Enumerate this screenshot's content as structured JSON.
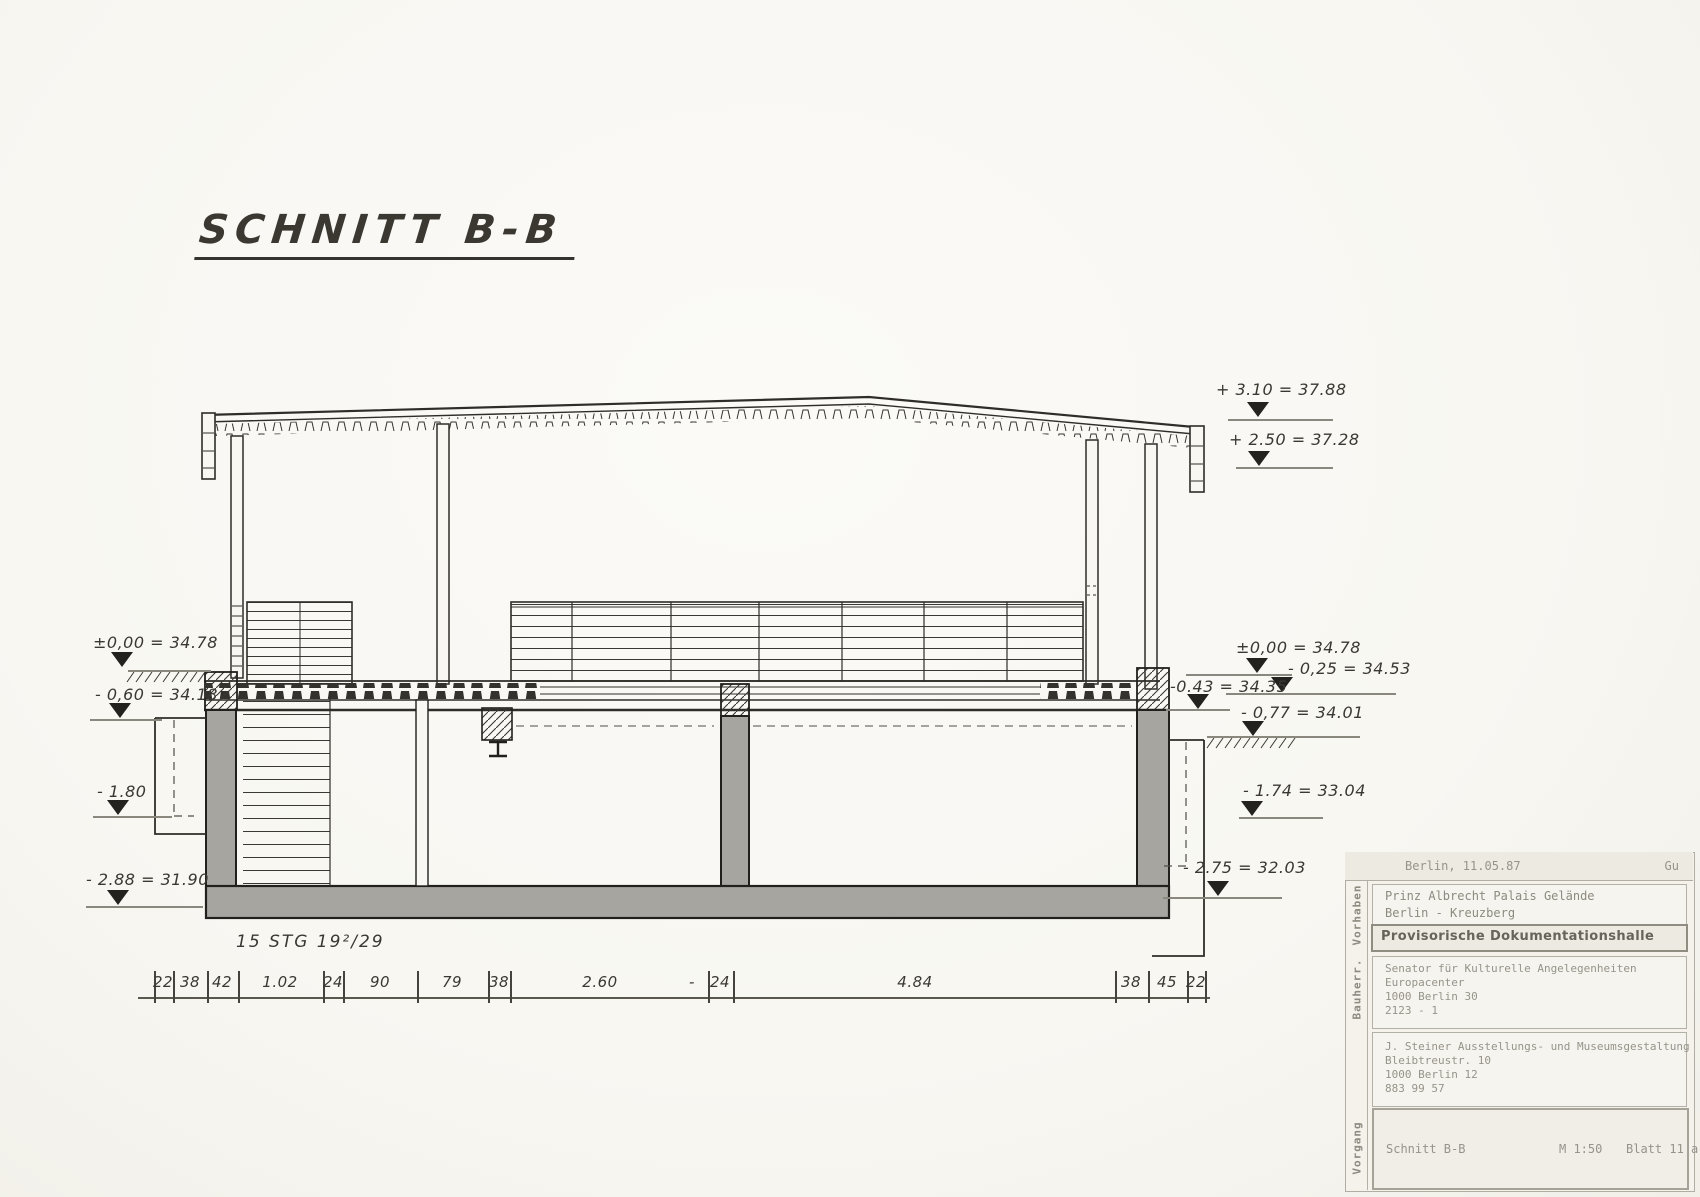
{
  "paper": {
    "background": "#f8f7f2",
    "ink": "#2e2d28",
    "concrete_fill": "#a7a5a0",
    "hand_ink": "#3a3831",
    "typewriter_ink": "#96938a"
  },
  "drawing_title": {
    "text": "SCHNITT B-B"
  },
  "stair_note": {
    "text": "15 STG 19²/29"
  },
  "elevation_markers": [
    {
      "side": "left",
      "label": "±0,00 = 34.78",
      "lx": 93,
      "ly": 633,
      "tx": 122,
      "ty": 652,
      "x1": 128,
      "x2": 211,
      "yl": 670
    },
    {
      "side": "left",
      "label": "- 0,60 = 34.18",
      "lx": 95,
      "ly": 685,
      "tx": 120,
      "ty": 703,
      "x1": 90,
      "x2": 162,
      "yl": 719
    },
    {
      "side": "left",
      "label": "- 1.80",
      "lx": 97,
      "ly": 782,
      "tx": 118,
      "ty": 800,
      "x1": 93,
      "x2": 172,
      "yl": 816
    },
    {
      "side": "left",
      "label": "- 2.88 = 31.90",
      "lx": 86,
      "ly": 870,
      "tx": 118,
      "ty": 890,
      "x1": 86,
      "x2": 203,
      "yl": 906
    },
    {
      "side": "right",
      "label": "+ 3.10 = 37.88",
      "lx": 1216,
      "ly": 380,
      "tx": 1258,
      "ty": 402,
      "x1": 1228,
      "x2": 1333,
      "yl": 419
    },
    {
      "side": "right",
      "label": "+ 2.50 = 37.28",
      "lx": 1229,
      "ly": 430,
      "tx": 1259,
      "ty": 451,
      "x1": 1236,
      "x2": 1333,
      "yl": 467
    },
    {
      "side": "right",
      "label": "±0,00  = 34.78",
      "lx": 1236,
      "ly": 638,
      "tx": 1257,
      "ty": 658,
      "x1": 1186,
      "x2": 1292,
      "yl": 674
    },
    {
      "side": "right",
      "label": "- 0,25 = 34.53",
      "lx": 1288,
      "ly": 659,
      "tx": 1282,
      "ty": 677,
      "x1": 1226,
      "x2": 1396,
      "yl": 693
    },
    {
      "side": "right",
      "label": "-0.43 = 34.35",
      "lx": 1170,
      "ly": 677,
      "tx": 1198,
      "ty": 694,
      "x1": 1166,
      "x2": 1230,
      "yl": 709
    },
    {
      "side": "right",
      "label": "- 0,77  = 34.01",
      "lx": 1241,
      "ly": 703,
      "tx": 1253,
      "ty": 721,
      "x1": 1207,
      "x2": 1360,
      "yl": 736
    },
    {
      "side": "right",
      "label": "- 1.74  = 33.04",
      "lx": 1243,
      "ly": 781,
      "tx": 1252,
      "ty": 801,
      "x1": 1239,
      "x2": 1323,
      "yl": 817
    },
    {
      "side": "right",
      "label": "- 2.75  = 32.03",
      "lx": 1183,
      "ly": 858,
      "tx": 1218,
      "ty": 881,
      "x1": 1163,
      "x2": 1282,
      "yl": 897
    }
  ],
  "dimension_chain": {
    "baseline_y": 997,
    "line_x1": 138,
    "line_x2": 1210,
    "ticks": [
      154,
      173,
      207,
      238,
      323,
      343,
      417,
      488,
      510,
      708,
      733,
      1115,
      1148,
      1187,
      1205
    ],
    "labels": [
      {
        "text": "22",
        "x": 163
      },
      {
        "text": "38",
        "x": 190
      },
      {
        "text": "42",
        "x": 222
      },
      {
        "text": "1.02",
        "x": 280
      },
      {
        "text": "24",
        "x": 333
      },
      {
        "text": "90",
        "x": 380
      },
      {
        "text": "79",
        "x": 452
      },
      {
        "text": "38",
        "x": 499
      },
      {
        "text": "2.60",
        "x": 600
      },
      {
        "text": "-",
        "x": 692
      },
      {
        "text": "24",
        "x": 720
      },
      {
        "text": "4.84",
        "x": 915
      },
      {
        "text": "38",
        "x": 1131
      },
      {
        "text": "45",
        "x": 1167
      },
      {
        "text": "22",
        "x": 1196
      }
    ]
  },
  "title_block": {
    "date": "Berlin, 11.05.87",
    "initials": "Gu",
    "vorhaben_label": "Vorhaben",
    "project_line1": "Prinz Albrecht Palais Gelände",
    "project_line2": "Berlin - Kreuzberg",
    "project_title": "Provisorische Dokumentationshalle",
    "bauherr_label": "Bauherr.",
    "client_lines": [
      "Senator für Kulturelle Angelegenheiten",
      "Europacenter",
      "1000 Berlin 30",
      "2123 - 1"
    ],
    "designer_lines": [
      "J. Steiner Ausstellungs- und Museumsgestaltung",
      "Bleibtreustr. 10",
      "1000 Berlin 12",
      "883 99 57"
    ],
    "vorgang_label": "Vorgang",
    "drawing_name": "Schnitt B-B",
    "scale": "M 1:50",
    "sheet": "Blatt 11 a"
  }
}
